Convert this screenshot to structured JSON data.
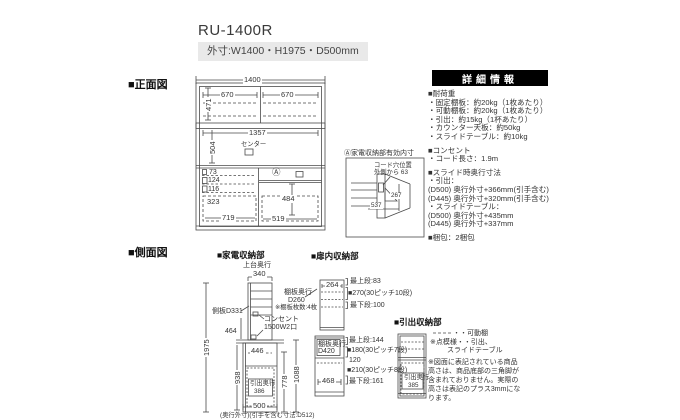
{
  "page": {
    "title": "RU-1400R",
    "dimensions_badge": "外寸:W1400・H1975・D500mm"
  },
  "colors": {
    "panel_header_bg": "#000000",
    "badge_bg": "#e9e9e9",
    "line_color": "#4a4a4a",
    "counter_fill": "#6e6e6e"
  },
  "front_view": {
    "heading": "■正面図",
    "dims": {
      "total_width": "1400",
      "upper_left_width": "670",
      "upper_right_width": "670",
      "upper_height": "471",
      "middle_width": "1357",
      "middle_height": "504",
      "center_label": "センター",
      "row1": "73",
      "row2": "124",
      "row3": "116",
      "lower_left_height": "323",
      "lower_left_width": "719",
      "lower_right_height": "484",
      "lower_right_width": "519",
      "a_mark": "Ⓐ"
    },
    "inset": {
      "title": "Ⓐ家電収納部有効内寸",
      "note_line1": "コード穴位置",
      "note_line2": "外側から 63",
      "dim_height": "267",
      "dim_depth": "537"
    }
  },
  "side_view": {
    "heading": "■側面図",
    "appliance_heading": "■家電収納部",
    "dims": {
      "total_height": "1975",
      "upper_depth_label": "上台奥行",
      "upper_depth": "340",
      "side_panel": "側板D331",
      "niche_height": "464",
      "base_height": "938",
      "inner_depth": "446",
      "drawer_label": "引出奥行",
      "drawer_depth": "386",
      "base_depth": "500",
      "right_dim1": "778",
      "right_dim2": "1088"
    },
    "outlet_label_line1": "コンセント",
    "outlet_label_line2": "1500W2口",
    "depth_note": "(奥行外寸)(引手を含む寸法:D512)"
  },
  "door_storage": {
    "heading": "■扉内収納部",
    "upper": {
      "width_dim": "264",
      "shelf_label_line1": "棚板奥行",
      "shelf_label_line2": "D260",
      "shelf_label_line3": "※棚板枚数:4枚",
      "notes": [
        "最上段:83",
        "■270(30ピッチ10段)",
        "最下段:100"
      ]
    },
    "lower": {
      "shelf_label_line1": "棚板奥行",
      "shelf_label_line2": "D420",
      "width_dim": "468",
      "notes": [
        "最上段:144",
        "■180(30ピッチ7段)",
        "120",
        "■210(30ピッチ8段)",
        "最下段:161"
      ]
    }
  },
  "drawer_storage": {
    "heading": "■引出収納部",
    "label_line1": "引出奥行",
    "label_line2": "385"
  },
  "legend": {
    "movable_shelf": "・・可動棚",
    "dotted_line1": "※点模様・・引出、",
    "dotted_line2": "スライドテーブル",
    "note_lines": [
      "※図面に表記されている商品",
      "高さは、商品底部の三角脚が",
      "含まれておりません。実際の",
      "高さは表記のプラス3mmにな",
      "ります。"
    ]
  },
  "details_panel": {
    "header": "詳細情報",
    "lines": [
      "■耐荷重",
      "・固定棚板：約20kg（1枚あたり）",
      "・可動棚板：約20kg（1枚あたり）",
      "・引出：約15kg（1杯あたり）",
      "・カウンター天板：約50kg",
      "・スライドテーブル：約10kg",
      "",
      "■コンセント",
      "・コード長さ：1.9m",
      "",
      "■スライド時奥行寸法",
      "・引出：",
      "(D500) 奥行外寸+366mm(引手含む)",
      "(D445) 奥行外寸+320mm(引手含む)",
      "・スライドテーブル：",
      "(D500) 奥行外寸+435mm",
      "(D445) 奥行外寸+337mm",
      "",
      "■梱包：2梱包"
    ]
  }
}
